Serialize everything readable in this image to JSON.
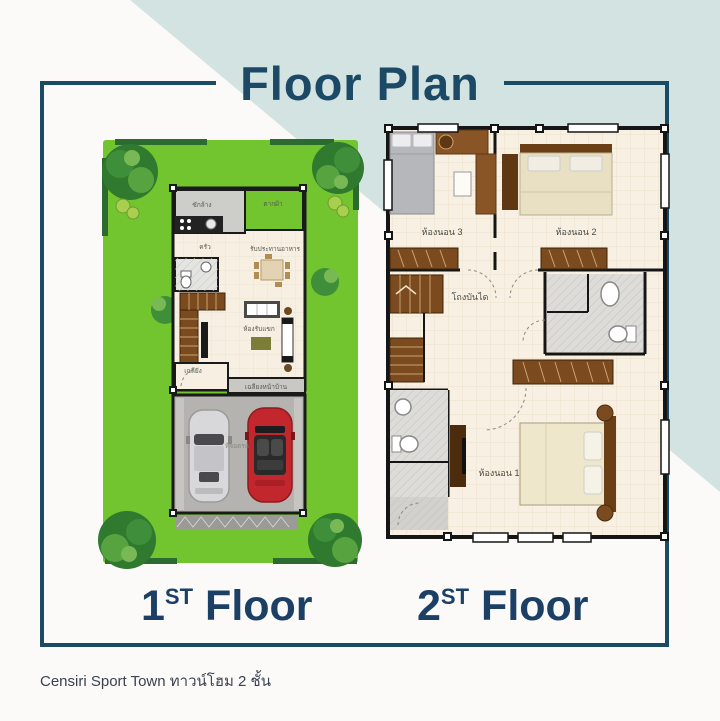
{
  "title": "Floor Plan",
  "caption": "Censiri  Sport Town ทาวน์โฮม 2 ชั้น",
  "floor_labels": {
    "first": {
      "num": "1",
      "sup": "ST",
      "word": "Floor"
    },
    "second": {
      "num": "2",
      "sup": "ST",
      "word": "Floor"
    }
  },
  "floor1": {
    "rooms": {
      "laundry": "ซักล้าง",
      "drying": "ตากผ้า",
      "kitchen": "ครัว",
      "dining": "รับประทานอาหาร",
      "living": "ห้องรับแขก",
      "entry": "เฉลียง",
      "porch": "เฉลียงหน้าบ้าน",
      "parking": "ที่จอดรถ"
    }
  },
  "floor2": {
    "rooms": {
      "bedroom1": "ห้องนอน 1",
      "bedroom2": "ห้องนอน 2",
      "bedroom3": "ห้องนอน 3",
      "stair_hall": "โถงบันได"
    }
  },
  "colors": {
    "navy": "#1c4a66",
    "teal_band": "#d2e3e2",
    "lawn_green": "#72c52f",
    "wall_black": "#1a1a1a",
    "wood_brown": "#7b4a1f",
    "floor_cream": "#f6efe2",
    "garage_gray": "#b4b3af",
    "car_red": "#c1272d",
    "car_silver": "#d8d8da"
  }
}
